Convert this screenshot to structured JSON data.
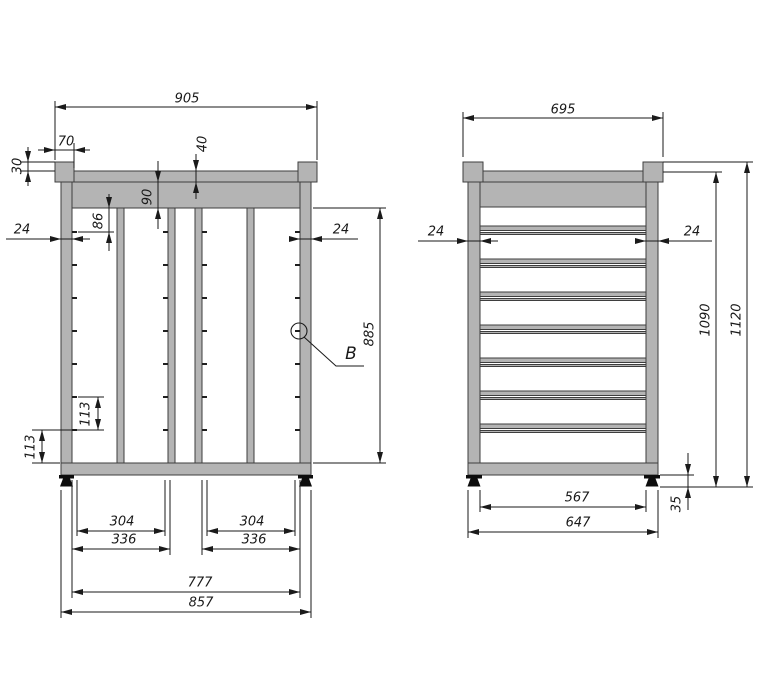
{
  "front_view": {
    "dim_overall_width": "905",
    "dim_cap_width": "70",
    "dim_cap_rise": "30",
    "dim_rail_thickness": "40",
    "dim_header_height": "90",
    "dim_hook_start": "86",
    "dim_post_left": "24",
    "dim_post_right": "24",
    "dim_inner_height": "885",
    "dim_hook_pitch": "113",
    "dim_hook_bottom": "113",
    "dim_opening_left": "304",
    "dim_bay_left": "336",
    "dim_opening_right": "304",
    "dim_bay_right": "336",
    "dim_inner_width": "777",
    "dim_base_width": "857",
    "detail_label": "B",
    "hook_columns": 4,
    "hooks_per_column": 7
  },
  "side_view": {
    "dim_overall_width": "695",
    "dim_post_left": "24",
    "dim_post_right": "24",
    "dim_inner_height": "1090",
    "dim_overall_height": "1120",
    "dim_foot_height": "35",
    "dim_inner_width": "567",
    "dim_base_width": "647",
    "rung_count": 7
  },
  "colors": {
    "frame_fill": "#b4b4b4",
    "outline": "#3e3e3e",
    "dimension_line": "#1a1a1a",
    "foot_fill": "#0d0d0d",
    "background": "#ffffff"
  }
}
